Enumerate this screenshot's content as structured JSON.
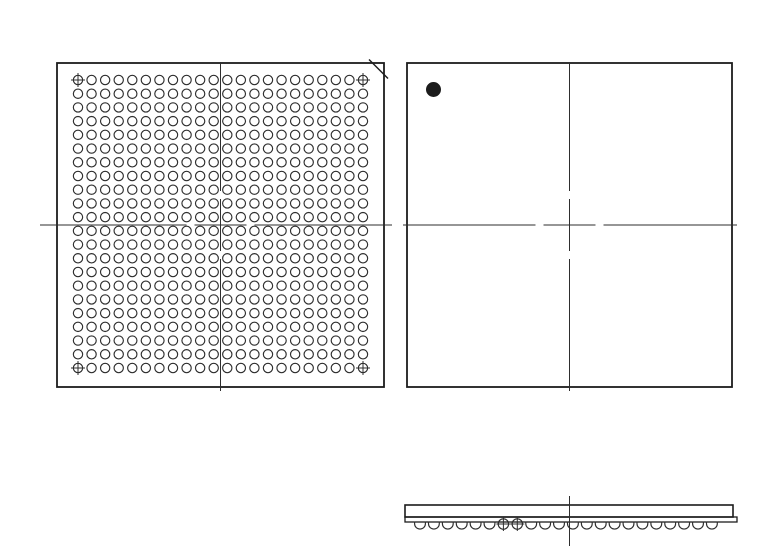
{
  "page": {
    "width": 769,
    "height": 554,
    "background": "#ffffff"
  },
  "drawing": {
    "title": "BGA package outline drawing (bottom view ball grid, top view with pin-1 marker, side view)",
    "stroke_color": "#1c1c1c",
    "thin_color": "#2e2e2e",
    "centerline_pattern": {
      "center_half": 26,
      "gap": 8
    },
    "views": {
      "bottom_view": {
        "label": "bottom-view-ball-grid",
        "outline": {
          "x": 57,
          "y": 63,
          "w": 327,
          "h": 324,
          "stroke_w": 1.8
        },
        "chamfer": {
          "x1": 369,
          "y1": 59.5,
          "x2": 388,
          "y2": 78.5,
          "stroke_w": 1.4
        },
        "ball_grid": {
          "rows": 22,
          "cols": 22,
          "first_cx": 78,
          "first_cy": 80,
          "pitch_x": 13.571,
          "pitch_y": 13.714,
          "ball_r": 4.65,
          "stroke_w": 1.15,
          "fiducial_corners": true,
          "fiducial_arm": 7
        },
        "centerline_v": {
          "x": 220.5,
          "y1": 62,
          "y2": 391,
          "cross_at": 225
        },
        "centerline_h": {
          "y": 225,
          "x1": 40,
          "x2": 392,
          "cross_at": 220.5
        }
      },
      "top_view": {
        "label": "top-view",
        "outline": {
          "x": 407,
          "y": 63,
          "w": 325,
          "h": 324,
          "stroke_w": 1.8
        },
        "pin1_dot": {
          "cx": 433.5,
          "cy": 89.5,
          "r": 7.5,
          "fill": "#1c1c1c"
        },
        "centerline_v": {
          "x": 569.5,
          "y1": 63,
          "y2": 391,
          "cross_at": 225
        },
        "centerline_h": {
          "y": 225,
          "x1": 403,
          "x2": 737,
          "cross_at": 569.5
        }
      },
      "side_view": {
        "label": "side-view",
        "body": {
          "x": 405,
          "y": 505,
          "w": 328,
          "h": 12,
          "stroke_w": 1.6
        },
        "substrate": {
          "x": 405,
          "y": 517,
          "w": 332,
          "h": 5,
          "stroke_w": 1.3
        },
        "balls": {
          "count": 22,
          "first_cx": 420,
          "pitch": 13.9,
          "r": 5.4,
          "top_y": 521.5,
          "stub": 2.2,
          "stroke_w": 1.15,
          "cross_indices": [
            6,
            7
          ],
          "cross_r": 5.2,
          "cross_arm": 7,
          "cross_cy": 524
        },
        "centerline_v": {
          "x": 569.5,
          "y1": 496,
          "y2": 546
        }
      }
    }
  }
}
